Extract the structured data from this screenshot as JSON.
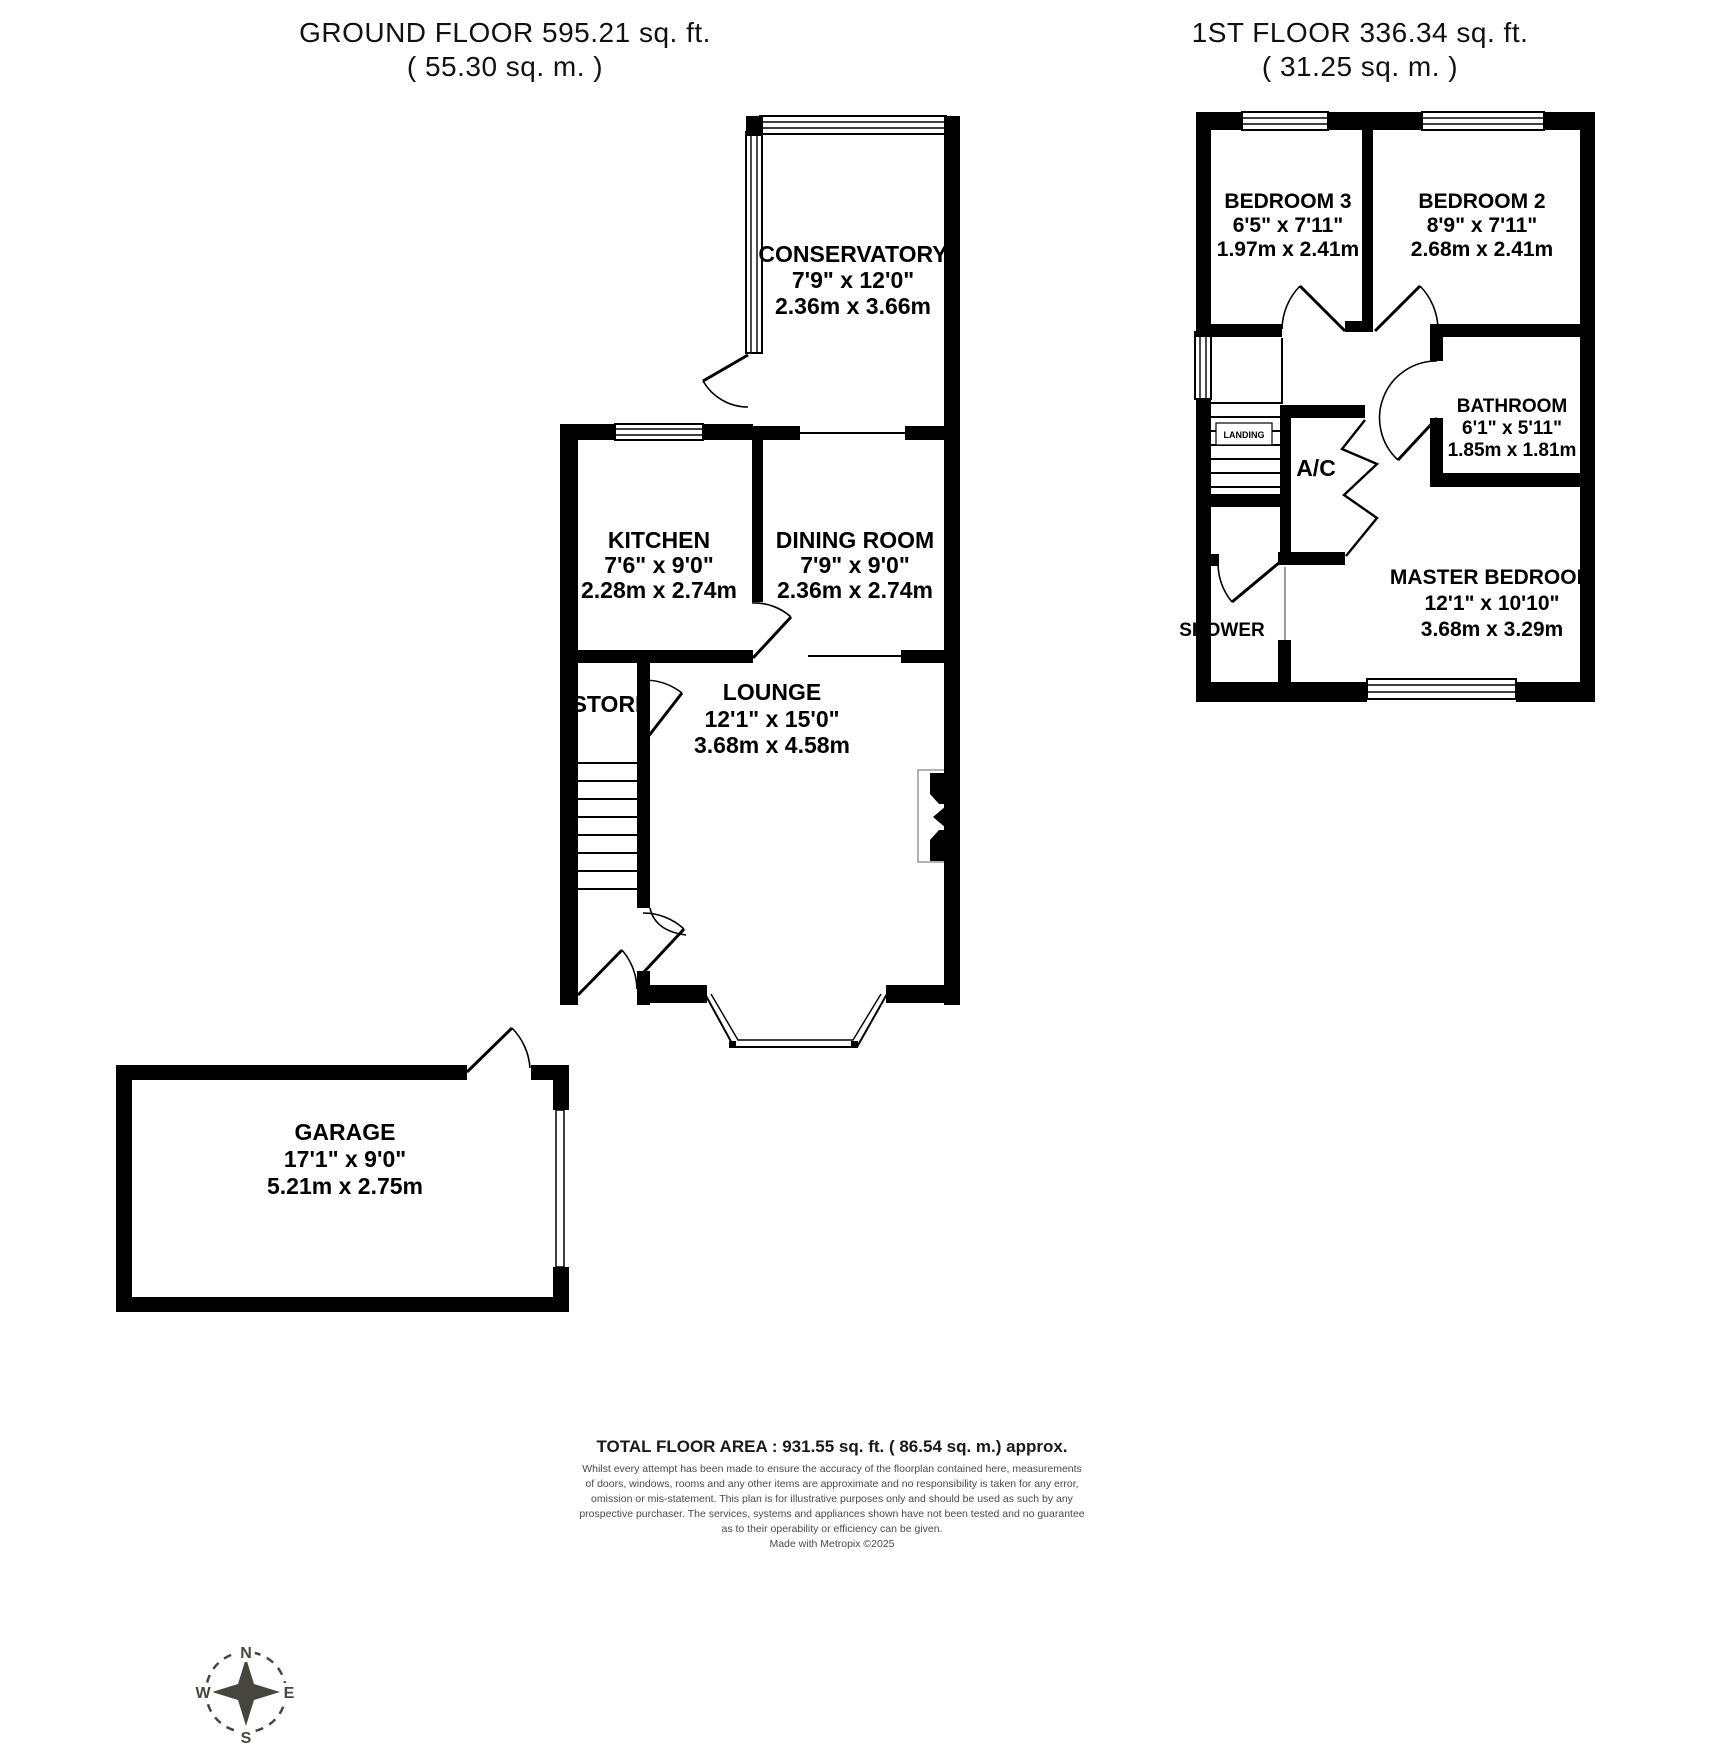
{
  "floors": {
    "ground": {
      "title": "GROUND FLOOR 595.21 sq. ft.",
      "subtitle": "( 55.30 sq. m. )",
      "rooms": {
        "conservatory": {
          "name": "CONSERVATORY",
          "imperial": "7'9\" x 12'0\"",
          "metric": "2.36m x 3.66m"
        },
        "kitchen": {
          "name": "KITCHEN",
          "imperial": "7'6\" x 9'0\"",
          "metric": "2.28m x 2.74m"
        },
        "dining": {
          "name": "DINING ROOM",
          "imperial": "7'9\" x 9'0\"",
          "metric": "2.36m x 2.74m"
        },
        "store": {
          "name": "STORE"
        },
        "lounge": {
          "name": "LOUNGE",
          "imperial": "12'1\" x 15'0\"",
          "metric": "3.68m x 4.58m"
        },
        "garage": {
          "name": "GARAGE",
          "imperial": "17'1\" x 9'0\"",
          "metric": "5.21m x 2.75m"
        }
      }
    },
    "first": {
      "title": "1ST FLOOR 336.34 sq. ft.",
      "subtitle": "( 31.25 sq. m. )",
      "rooms": {
        "bedroom3": {
          "name": "BEDROOM 3",
          "imperial": "6'5\" x 7'11\"",
          "metric": "1.97m x 2.41m"
        },
        "bedroom2": {
          "name": "BEDROOM 2",
          "imperial": "8'9\" x 7'11\"",
          "metric": "2.68m x 2.41m"
        },
        "bathroom": {
          "name": "BATHROOM",
          "imperial": "6'1\" x 5'11\"",
          "metric": "1.85m x 1.81m"
        },
        "master": {
          "name": "MASTER BEDROOM",
          "imperial": "12'1\" x 10'10\"",
          "metric": "3.68m x 3.29m"
        },
        "landing": {
          "name": "LANDING"
        },
        "ac": {
          "name": "A/C"
        },
        "shower": {
          "name": "SHOWER"
        }
      }
    }
  },
  "footer": {
    "total": "TOTAL FLOOR AREA : 931.55 sq. ft. ( 86.54 sq. m.) approx.",
    "disclaimer_lines": [
      "Whilst every attempt has been made to ensure the accuracy of the floorplan contained here, measurements",
      "of doors, windows, rooms and any other items are approximate and no responsibility is taken for any error,",
      "omission or mis-statement. This plan is for illustrative purposes only and should be used as such by any",
      "prospective purchaser. The services, systems and appliances shown have not been tested and no guarantee",
      "as to their operability or efficiency can be given.",
      "Made with Metropix ©2025"
    ]
  },
  "compass": {
    "n": "N",
    "e": "E",
    "s": "S",
    "w": "W"
  },
  "colors": {
    "wall": "#000000",
    "compass": "#46463e",
    "disclaimer": "#4a4a4a"
  }
}
